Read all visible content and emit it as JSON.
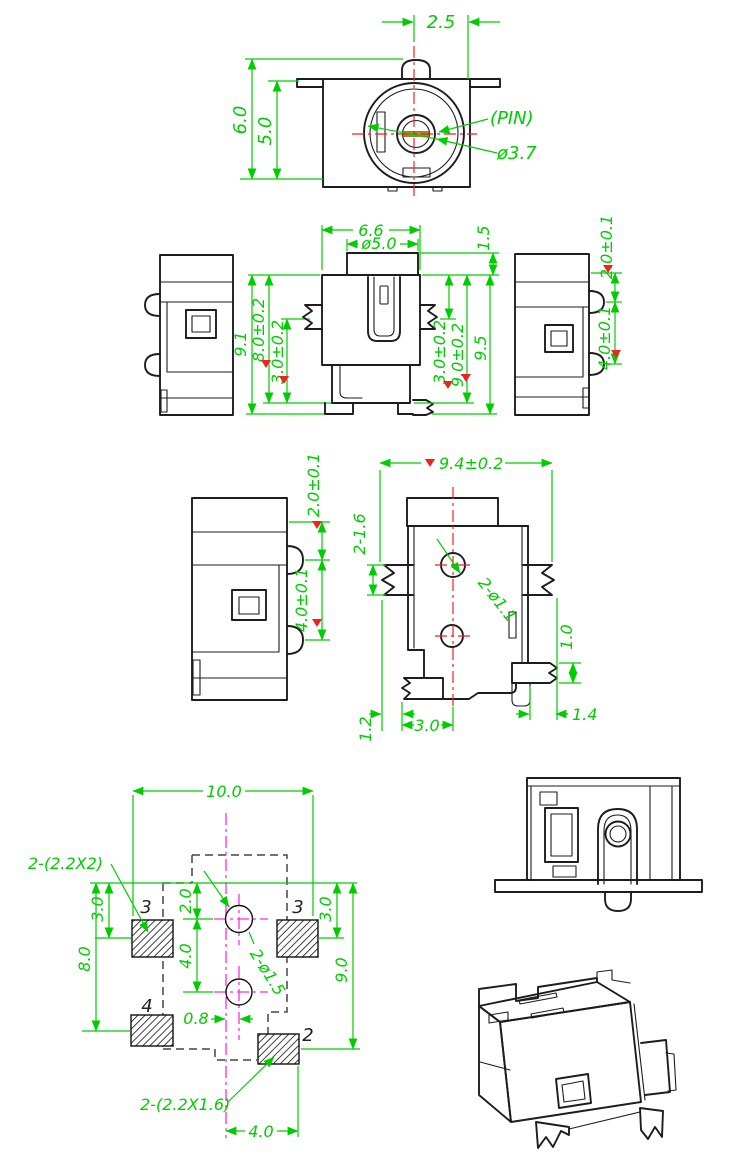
{
  "colors": {
    "dim": "#00cd00",
    "red": "#ee2222",
    "magenta": "#ff2be2",
    "outline": "#1d1d1d",
    "dash": "#454545",
    "gold": "#a78a1e"
  },
  "views": {
    "top": {
      "dim_pin_offset": "2.5",
      "dim_height_outer": "6.0",
      "dim_height_inner": "5.0",
      "label_pin": "(PIN)",
      "dim_pin_diameter": "ø3.7"
    },
    "side_left": {
      "dim_overall": "9.1",
      "dim_body": "8.0±0.2",
      "dim_flange": "3.0±0.2"
    },
    "front": {
      "dim_width": "6.6",
      "dim_barrel": "ø5.0",
      "dim_cap": "1.5",
      "dim_flange": "3.0±0.2",
      "dim_body": "9.0±0.2",
      "dim_overall": "9.5"
    },
    "side_right": {
      "dim_top": "2.0±0.1",
      "dim_lug_pitch": "4.0±0.1"
    },
    "side_enlarged": {
      "dim_top": "2.0±0.1",
      "dim_lug_pitch": "4.0±0.1"
    },
    "bottom": {
      "dim_width": "9.4±0.2",
      "dim_flange_width": "2-1.6",
      "dim_holes": "2-ø1.1",
      "dim_foot_height": "1.0",
      "dim_foot_offset": "1.2",
      "dim_center": "3.0",
      "dim_foot_width": "1.4"
    },
    "pcb": {
      "dim_width": "10.0",
      "label_pads_upper": "2-(2.2X2)",
      "dim_left_top": "3.0",
      "dim_left_span": "8.0",
      "dim_hole_top": "2.0",
      "dim_hole_pitch": "4.0",
      "dim_hole_offset": "0.8",
      "dim_right_top": "3.0",
      "dim_right_span": "9.0",
      "label_holes": "2-ø1.5",
      "label_pads_lower": "2-(2.2X1.6)",
      "dim_pad_offset": "4.0",
      "pin_top_left": "3",
      "pin_top_right": "3",
      "pin_bottom_left": "4",
      "pin_bottom_right": "2"
    }
  }
}
